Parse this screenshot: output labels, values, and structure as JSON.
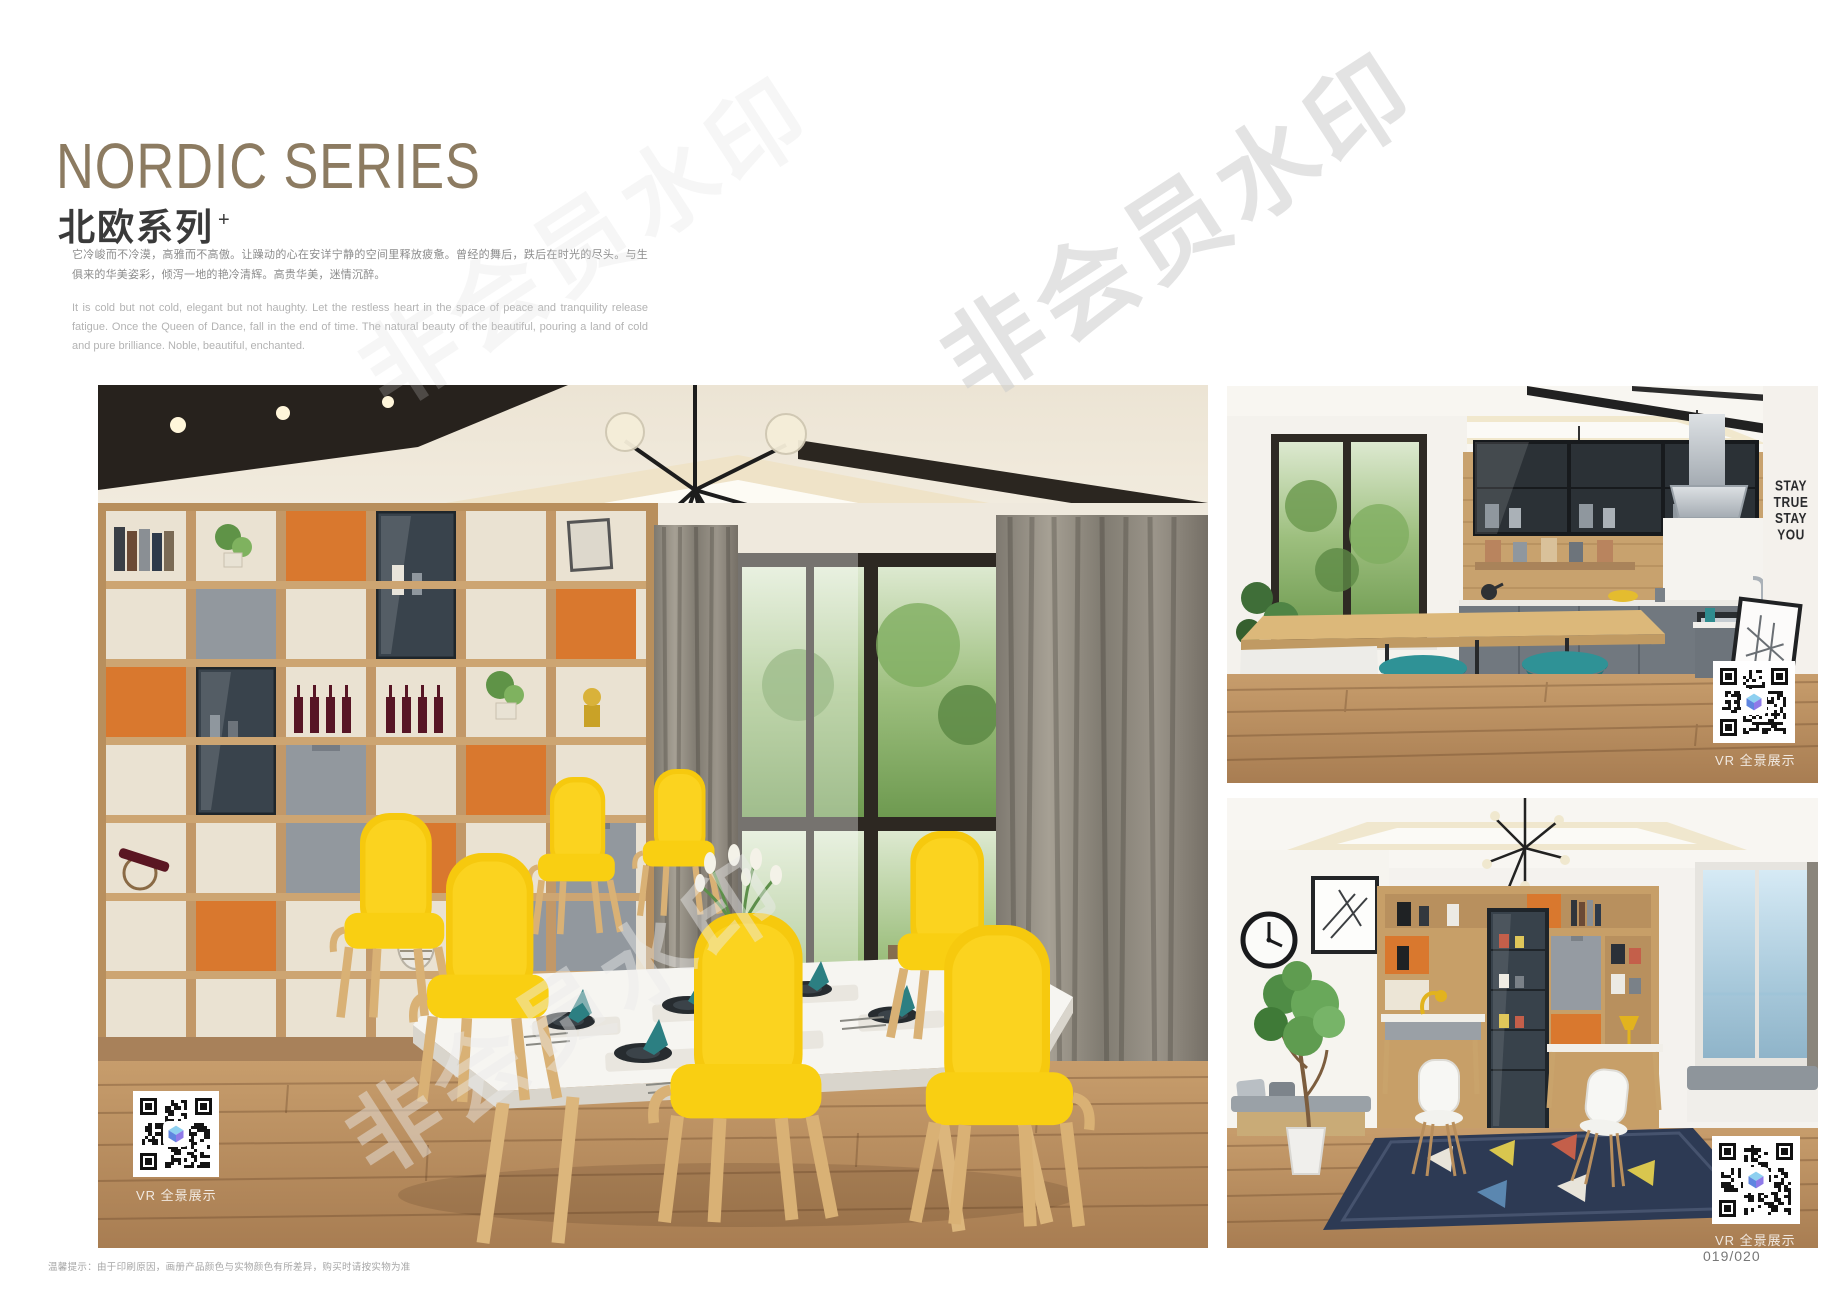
{
  "header": {
    "title_en": "NORDIC SERIES",
    "title_cn": "北欧系列",
    "title_sup": "+",
    "desc_cn": "它冷峻而不冷漠，高雅而不高傲。让躁动的心在安详宁静的空间里释放疲惫。曾经的舞后，跌后在时光的尽头。与生俱来的华美姿彩，倾泻一地的艳冷清辉。高贵华美，迷情沉醉。",
    "desc_en": "It is cold but not cold, elegant but not haughty. Let the restless heart in the space of peace and tranquility release fatigue. Once the Queen of Dance, fall in the end of time. The natural beauty of the beautiful, pouring a land of cold and pure brilliance. Noble, beautiful, enchanted."
  },
  "watermark": {
    "text": "非会员水印"
  },
  "gallery": {
    "photos": [
      {
        "id": "dining-room",
        "vr_label": "VR 全景展示"
      },
      {
        "id": "kitchen",
        "vr_label": "VR 全景展示",
        "wall_art": [
          "STAY",
          "TRUE",
          "STAY",
          "YOU"
        ]
      },
      {
        "id": "study",
        "vr_label": "VR 全景展示"
      }
    ]
  },
  "footer": {
    "note": "温馨提示：由于印刷原因，画册产品颜色与实物颜色有所差异，购买时请按实物为准",
    "page_number": "019/020"
  },
  "colors": {
    "title": "#8c7b61",
    "accent_yellow": "#f6c90e",
    "accent_teal": "#2b8a8e",
    "accent_orange": "#d9782e",
    "wood": "#c79f68",
    "qr_cube_blue": "#8ed0f0",
    "qr_cube_purple": "#8f7ae8"
  }
}
